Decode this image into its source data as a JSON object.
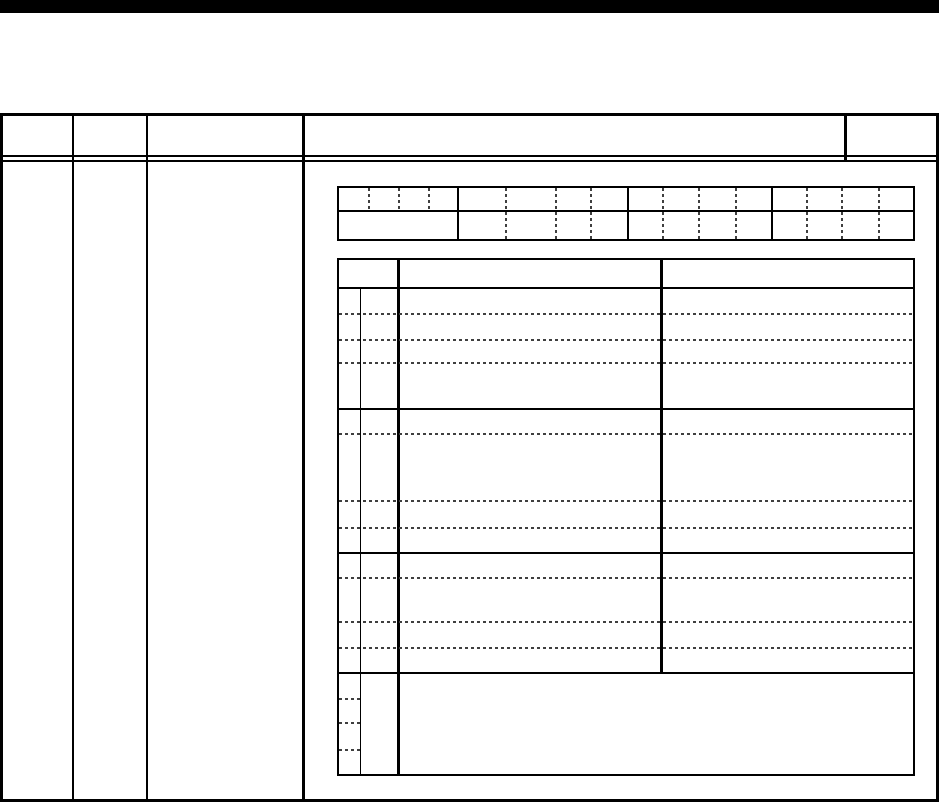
{
  "page": {
    "background_color": "#ffffff",
    "top_bar_color": "#000000",
    "solid_line_color": "#000000",
    "dotted_line_color": "#3f3f3f",
    "text_content": ""
  },
  "outer_table": {
    "header_columns": 5,
    "body_columns": 4,
    "header_cell_text": [
      "",
      "",
      "",
      "",
      ""
    ],
    "body_cell_text": [
      "",
      "",
      "",
      ""
    ]
  },
  "bit_grid_table": {
    "rows": 2,
    "groups": 4,
    "cells_per_group": 4,
    "row2_first_group_merged": true,
    "cell_text": ""
  },
  "detail_table": {
    "header_row_text": [
      "",
      "",
      ""
    ],
    "row_groups": 4,
    "dotted_rows_per_group": 4,
    "last_group_merged_body": true,
    "cell_text": ""
  }
}
